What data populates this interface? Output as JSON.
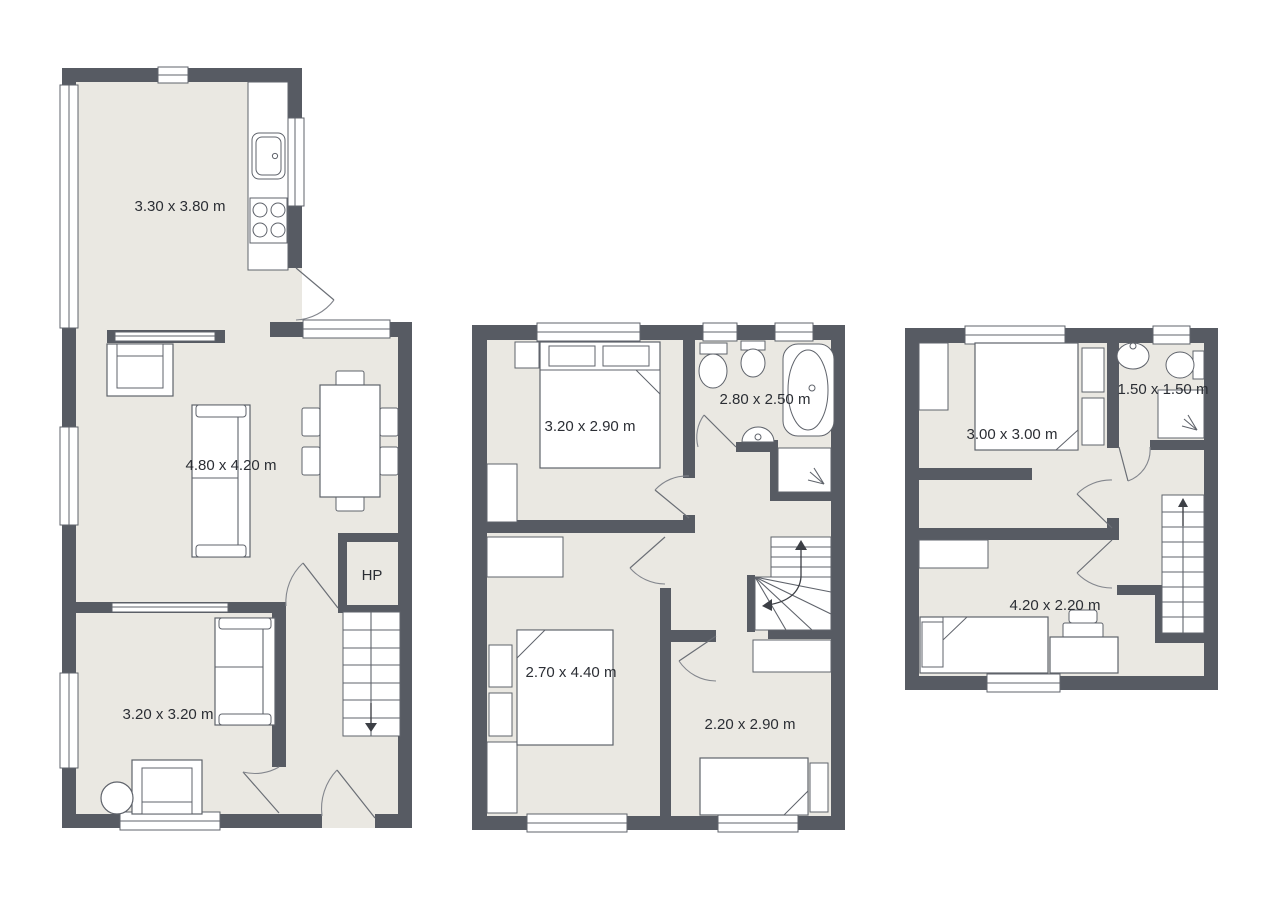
{
  "document": {
    "type": "floor-plan-set",
    "floor_count": 3
  },
  "floors": {
    "ground": {
      "kitchen": "3.30 x 3.80 m",
      "living_room": "4.80 x 4.20 m",
      "front_room": "3.20 x 3.20 m",
      "heat_pump": "HP"
    },
    "first": {
      "bedroom_front": "3.20 x 2.90 m",
      "bathroom": "2.80 x 2.50 m",
      "bedroom_left": "2.70 x 4.40 m",
      "bedroom_right": "2.20 x 2.90 m"
    },
    "second": {
      "bedroom": "3.00 x 3.00 m",
      "bathroom": "1.50 x 1.50 m",
      "bedroom_rear": "4.20 x 2.20 m"
    }
  },
  "colors": {
    "wall": "#575b63",
    "floor": "#eae8e2",
    "fixture": "#ffffff",
    "outline": "#5f636b",
    "text": "#2b2e34",
    "background": "#ffffff"
  }
}
